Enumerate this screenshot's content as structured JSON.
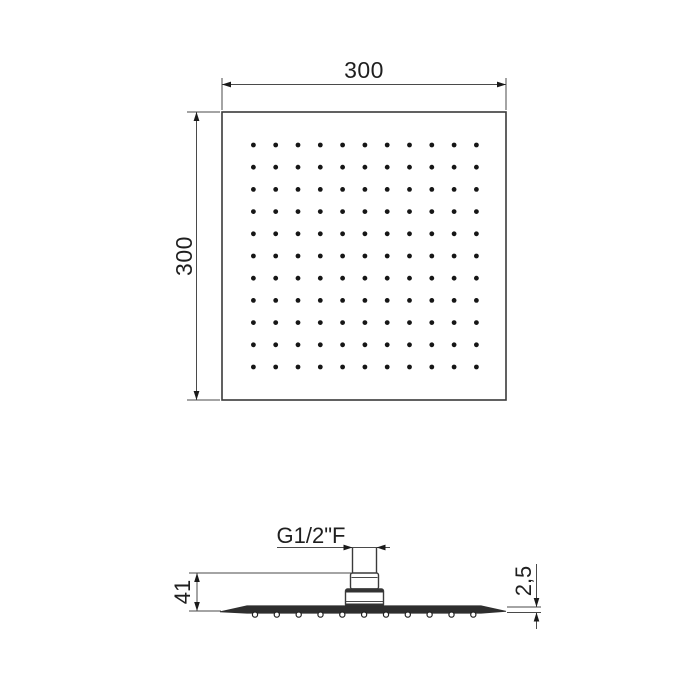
{
  "top_view": {
    "width_value": "300",
    "height_value": "300",
    "spray_grid": {
      "rows": 11,
      "cols": 11
    }
  },
  "side_view": {
    "thread_label": "G1/2\"F",
    "height_value": "41",
    "thickness_value": "2,5",
    "nozzle_count": 11
  },
  "colors": {
    "line": "#4a4a4a",
    "text": "#1f1f1f",
    "plate_fill": "#2e2e2e",
    "dot": "#161616"
  }
}
